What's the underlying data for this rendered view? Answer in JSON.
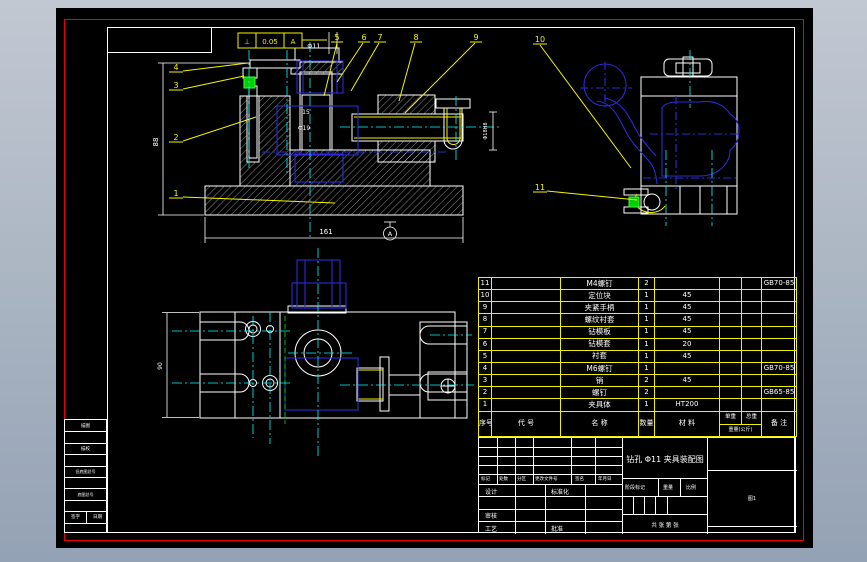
{
  "app": {
    "canvas_color": "#000000",
    "frame_color": "#ef0000",
    "sheet_line_color": "#ffffff",
    "bom_line_color": "#f0f000",
    "phantom_color": "#2a2ad8",
    "centerline_color": "#00ffff",
    "annotation_color": "#f5f500",
    "highlight_color": "#00d000",
    "background_top": "#c2c8d2",
    "background_bottom": "#94a2b5"
  },
  "bom": {
    "headers": {
      "no": "序号",
      "code": "代 号",
      "name": "名  称",
      "qty": "数量",
      "material": "材  料",
      "unit_weight": "单重",
      "total_weight": "总重",
      "weight_unit": "重量(公斤)",
      "remark": "备 注"
    },
    "rows": [
      {
        "no": "11",
        "code": "",
        "name": "M4螺钉",
        "qty": "2",
        "material": "",
        "unit_weight": "",
        "total_weight": "",
        "remark": "GB70-85"
      },
      {
        "no": "10",
        "code": "",
        "name": "定位块",
        "qty": "1",
        "material": "45",
        "unit_weight": "",
        "total_weight": "",
        "remark": ""
      },
      {
        "no": "9",
        "code": "",
        "name": "夹紧手柄",
        "qty": "1",
        "material": "45",
        "unit_weight": "",
        "total_weight": "",
        "remark": ""
      },
      {
        "no": "8",
        "code": "",
        "name": "螺纹衬套",
        "qty": "1",
        "material": "45",
        "unit_weight": "",
        "total_weight": "",
        "remark": ""
      },
      {
        "no": "7",
        "code": "",
        "name": "钻模板",
        "qty": "1",
        "material": "45",
        "unit_weight": "",
        "total_weight": "",
        "remark": ""
      },
      {
        "no": "6",
        "code": "",
        "name": "钻模套",
        "qty": "1",
        "material": "20",
        "unit_weight": "",
        "total_weight": "",
        "remark": ""
      },
      {
        "no": "5",
        "code": "",
        "name": "衬套",
        "qty": "1",
        "material": "45",
        "unit_weight": "",
        "total_weight": "",
        "remark": ""
      },
      {
        "no": "4",
        "code": "",
        "name": "M6螺钉",
        "qty": "1",
        "material": "",
        "unit_weight": "",
        "total_weight": "",
        "remark": "GB70-85"
      },
      {
        "no": "3",
        "code": "",
        "name": "销",
        "qty": "2",
        "material": "45",
        "unit_weight": "",
        "total_weight": "",
        "remark": ""
      },
      {
        "no": "2",
        "code": "",
        "name": "螺钉",
        "qty": "2",
        "material": "",
        "unit_weight": "",
        "total_weight": "",
        "remark": "GB65-85"
      },
      {
        "no": "1",
        "code": "",
        "name": "夹具体",
        "qty": "1",
        "material": "HT200",
        "unit_weight": "",
        "total_weight": "",
        "remark": ""
      }
    ]
  },
  "title_block": {
    "title": "钻孔 Φ11 夹具装配图",
    "revision_row": {
      "mark": "标记",
      "count": "处数",
      "zone": "分区",
      "doc_no": "更改文件号",
      "sign": "签名",
      "date": "年月日"
    },
    "signers": {
      "design": "设计",
      "check": "审核",
      "process": "工艺",
      "standard": "标准化",
      "approve": "批准"
    },
    "stage": "阶段标记",
    "weight": "重量",
    "scale": "比例",
    "sheets": "共 张 第 张",
    "org": "图1"
  },
  "aux_block": {
    "rows": [
      "描图",
      "",
      "描校",
      "",
      "旧底图总号",
      "",
      "底图总号",
      ""
    ],
    "sign": "签字",
    "date": "日期"
  },
  "annotations": {
    "balloons": [
      "1",
      "2",
      "3",
      "4",
      "5",
      "6",
      "7",
      "8",
      "9",
      "10",
      "11"
    ],
    "tolerance": {
      "symbol": "⊥",
      "value": "0.05",
      "datum": "A"
    },
    "dims": {
      "front_height": "88",
      "front_width": "161",
      "hole": "Φ11",
      "slot": "15",
      "bore": "Φ19",
      "shaft": "Φ18H8",
      "plan_height": "90",
      "datum_ref": "A"
    }
  }
}
